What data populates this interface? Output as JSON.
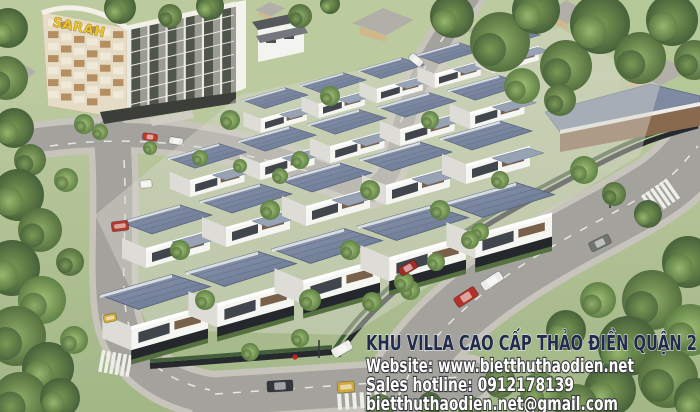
{
  "scene": {
    "building_sign": "SARAH",
    "colors": {
      "title_navy": "#232b4a",
      "overlay_white": "#ffffff",
      "sign_gold": "#e9c42a",
      "roof_slate": "#76829c",
      "asphalt": "#a3a29d"
    }
  },
  "overlay": {
    "title": "KHU VILLA CAO CẤP THẢO ĐIỀN QUẬN 2",
    "website": "Website: www.bietthuthaodien.net",
    "hotline": "Sales hotline: 0912178139",
    "email": "bietthuthaodien.net@gmail.com"
  }
}
